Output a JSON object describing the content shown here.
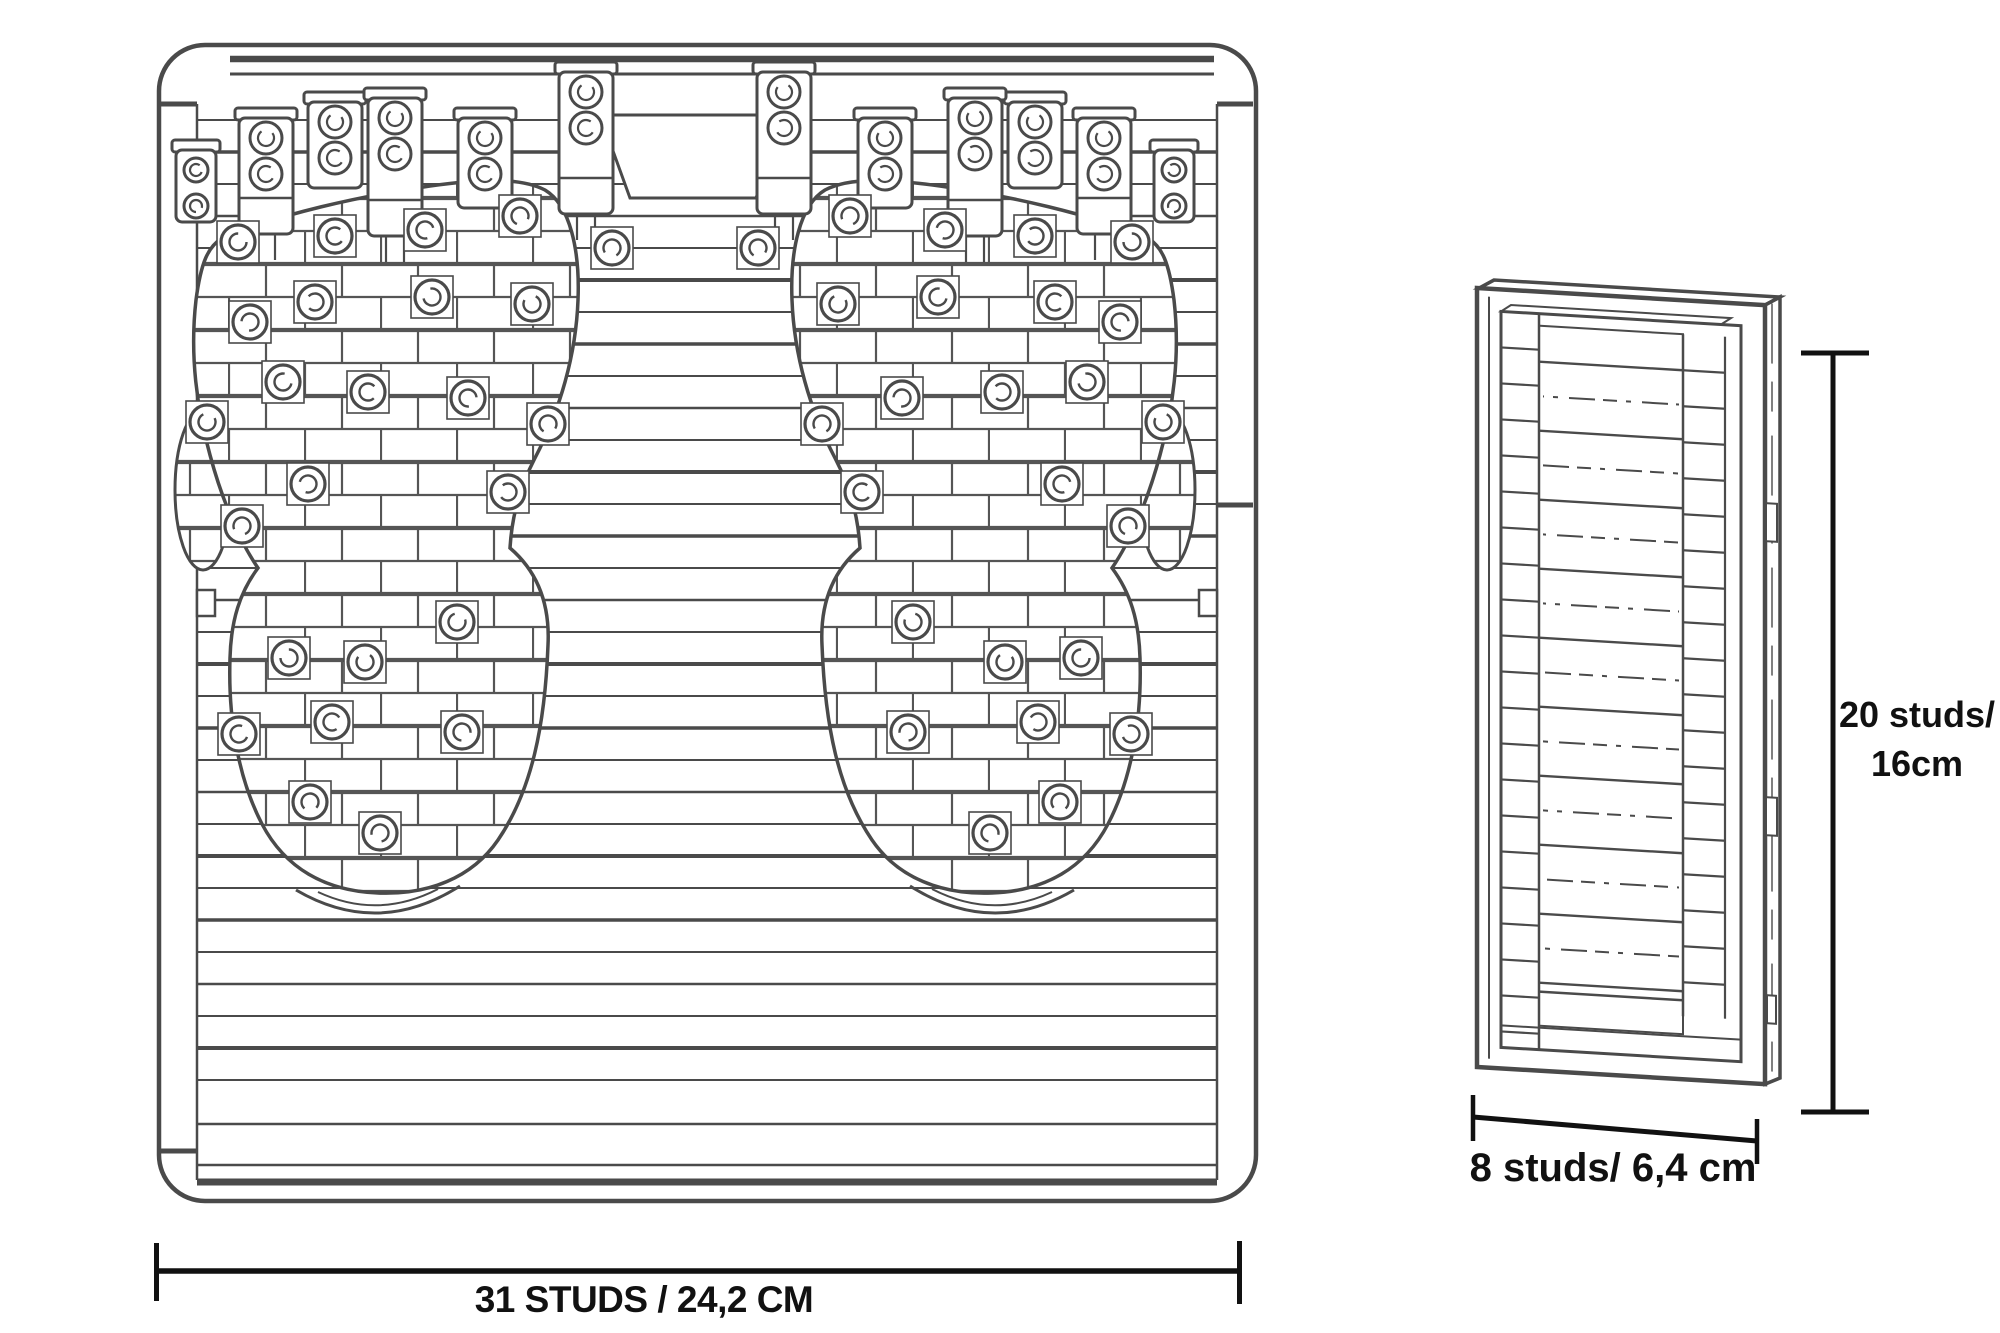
{
  "colors": {
    "background": "#ffffff",
    "drawing_line": "#4a4a4a",
    "annotation": "#111111"
  },
  "front_view": {
    "width_dimension_label": "31 STUDS / 24,2 CM"
  },
  "side_view": {
    "height_dimension_label_line1": "20 studs/",
    "height_dimension_label_line2": "16cm",
    "width_dimension_label": "8 studs/ 6,4 cm"
  }
}
